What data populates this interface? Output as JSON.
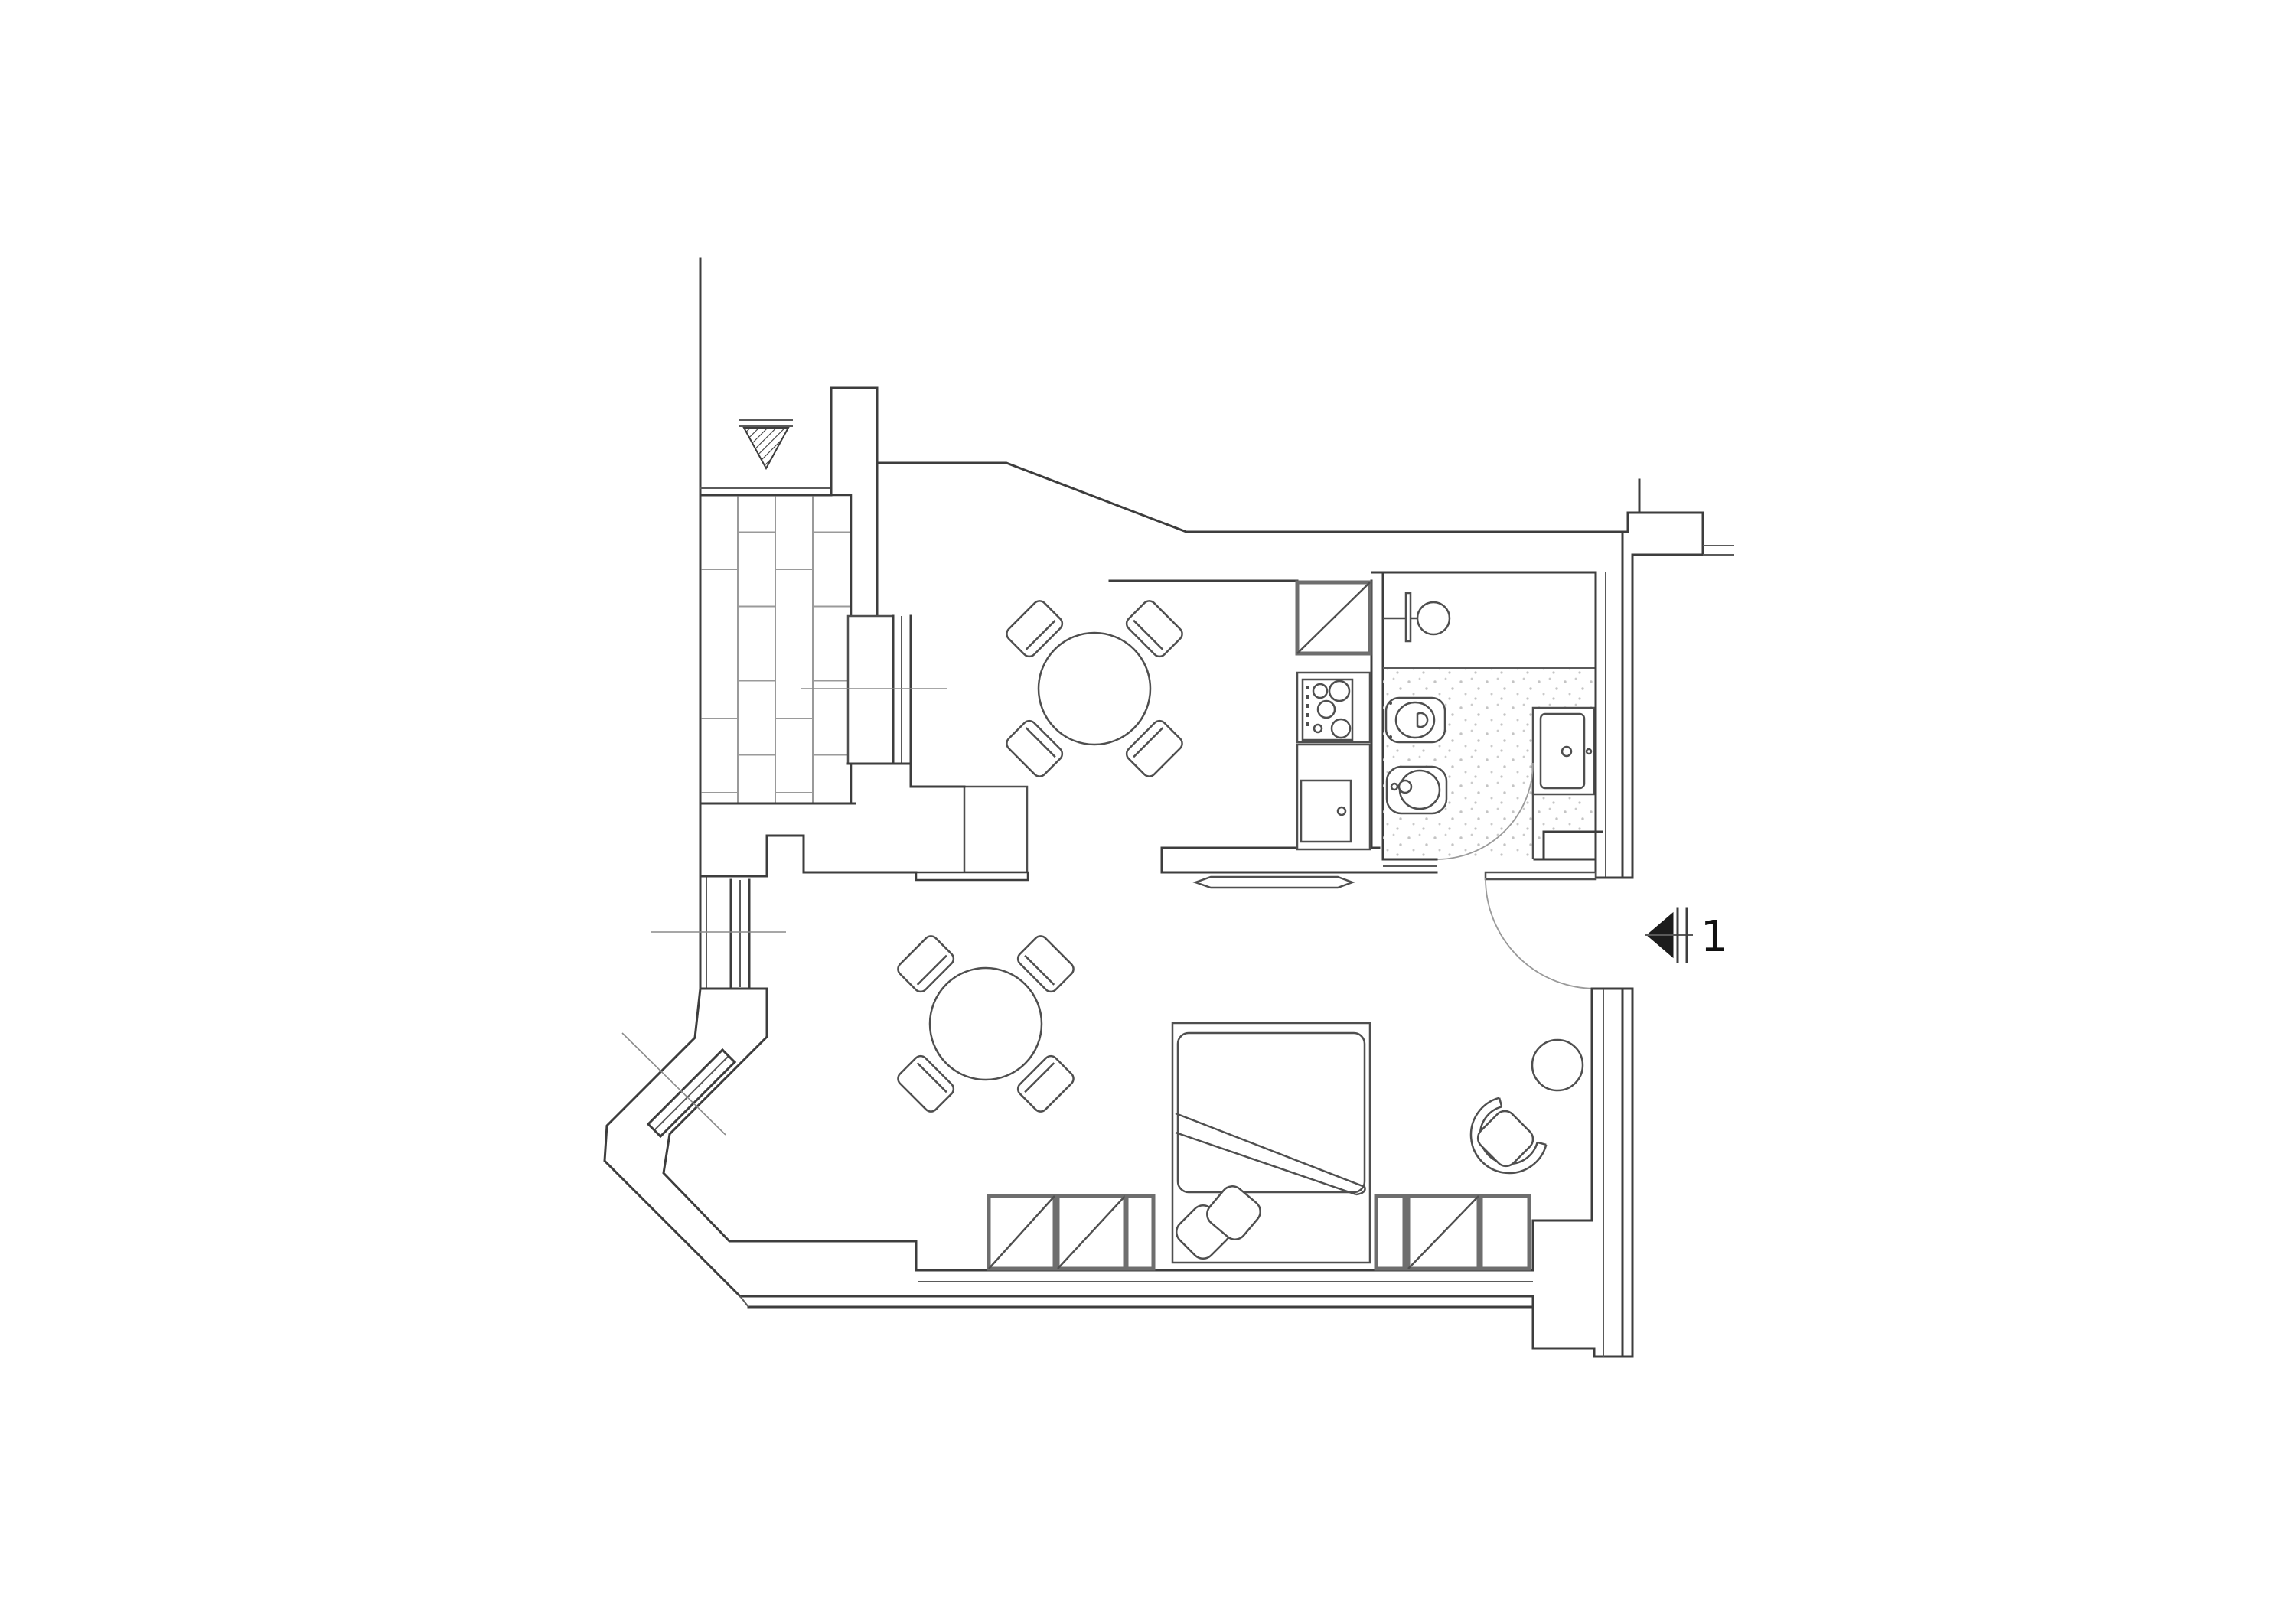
{
  "page": {
    "kind": "architectural floor plan drawing",
    "background": "#ffffff"
  },
  "plan": {
    "marker": {
      "label": "1",
      "symbol": "section-arrow-left"
    },
    "colors": {
      "wall_line": "#3d3d3d",
      "furniture_line": "#4f4f4f",
      "heavy_edge": "#6e6e6e",
      "centerline": "#8a8a8a",
      "tile_dot": "#c4c4c4",
      "brick_joint": "#9a9a9a",
      "marker_fill": "#1c1c1c"
    },
    "rooms": [
      {
        "name": "balcony",
        "floor": "brick-paving"
      },
      {
        "name": "dining-area"
      },
      {
        "name": "kitchen"
      },
      {
        "name": "bathroom",
        "floor": "tile-stipple"
      },
      {
        "name": "living-sleeping-area"
      },
      {
        "name": "entry"
      }
    ],
    "furniture": [
      "round-dining-table-upper",
      "four-chairs-upper",
      "round-dining-table-lower",
      "four-chairs-lower",
      "kitchen-fridge",
      "kitchen-stove",
      "kitchen-sink-cabinet",
      "washbasin",
      "toilet",
      "bidet",
      "shower-tray",
      "double-bed",
      "pillows",
      "wardrobe-left",
      "wardrobe-right",
      "armchair",
      "side-table",
      "balcony-door",
      "sliding-door",
      "entry-door",
      "bathroom-door",
      "window-left",
      "window-bay-diagonal",
      "void-triangle-symbol"
    ]
  }
}
